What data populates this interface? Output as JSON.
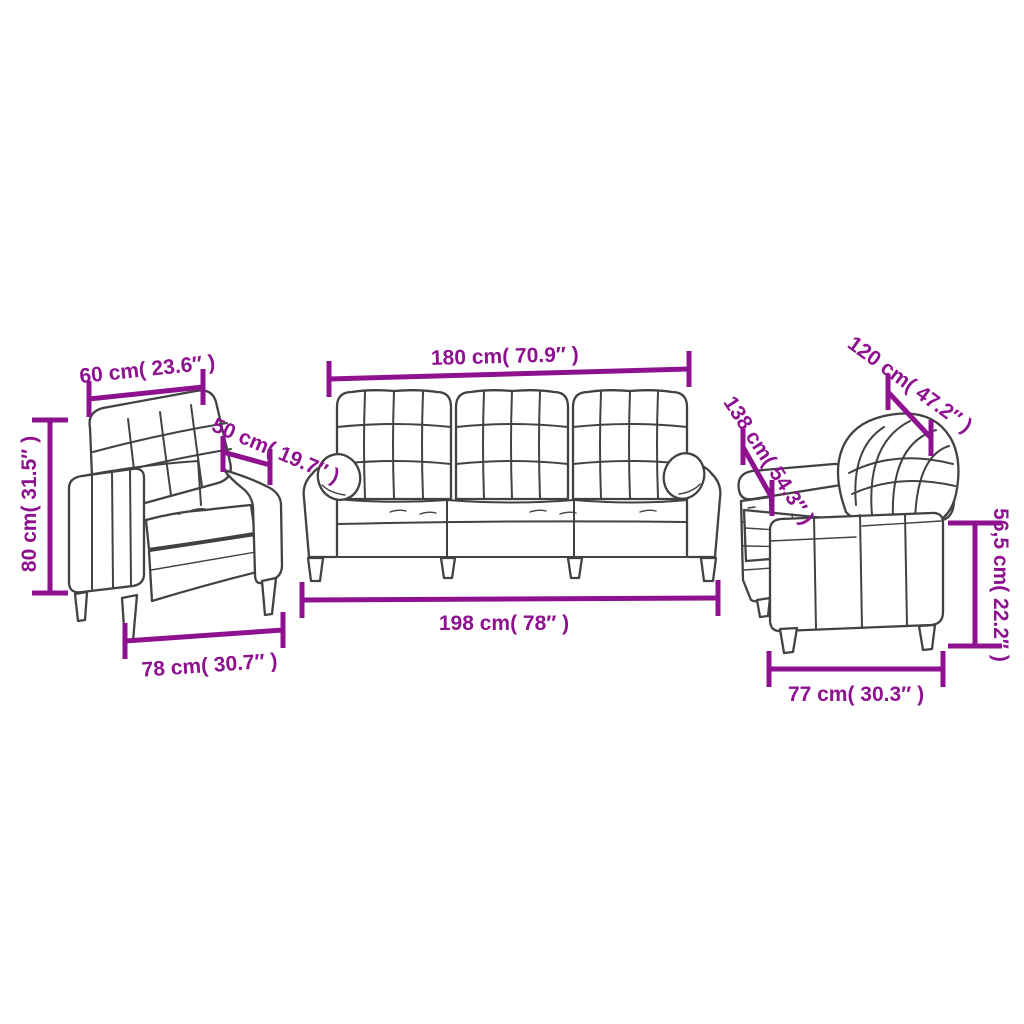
{
  "diagram_title": "3 piece sofa set dimension diagram",
  "colors": {
    "dimension_annotation": "#8e1190",
    "furniture_outline": "#424242",
    "background": "#ffffff"
  },
  "pieces": [
    {
      "name": "armchair",
      "dims": {
        "back_width": "60 cm( 23.6″ )",
        "seat_depth": "50 cm( 19.7″ )",
        "height": "80 cm( 31.5″ )",
        "base_width": "78 cm( 30.7″ )"
      }
    },
    {
      "name": "three-seater-sofa",
      "dims": {
        "back_width": "180 cm( 70.9″ )",
        "base_width": "198 cm( 78″ )"
      }
    },
    {
      "name": "two-seater-sofa",
      "dims": {
        "back_width": "120 cm( 47.2″ )",
        "overall_depth": "138 cm( 54.3″ )",
        "arm_height": "56,5 cm( 22.2″ )",
        "base_depth": "77 cm( 30.3″ )"
      }
    }
  ]
}
